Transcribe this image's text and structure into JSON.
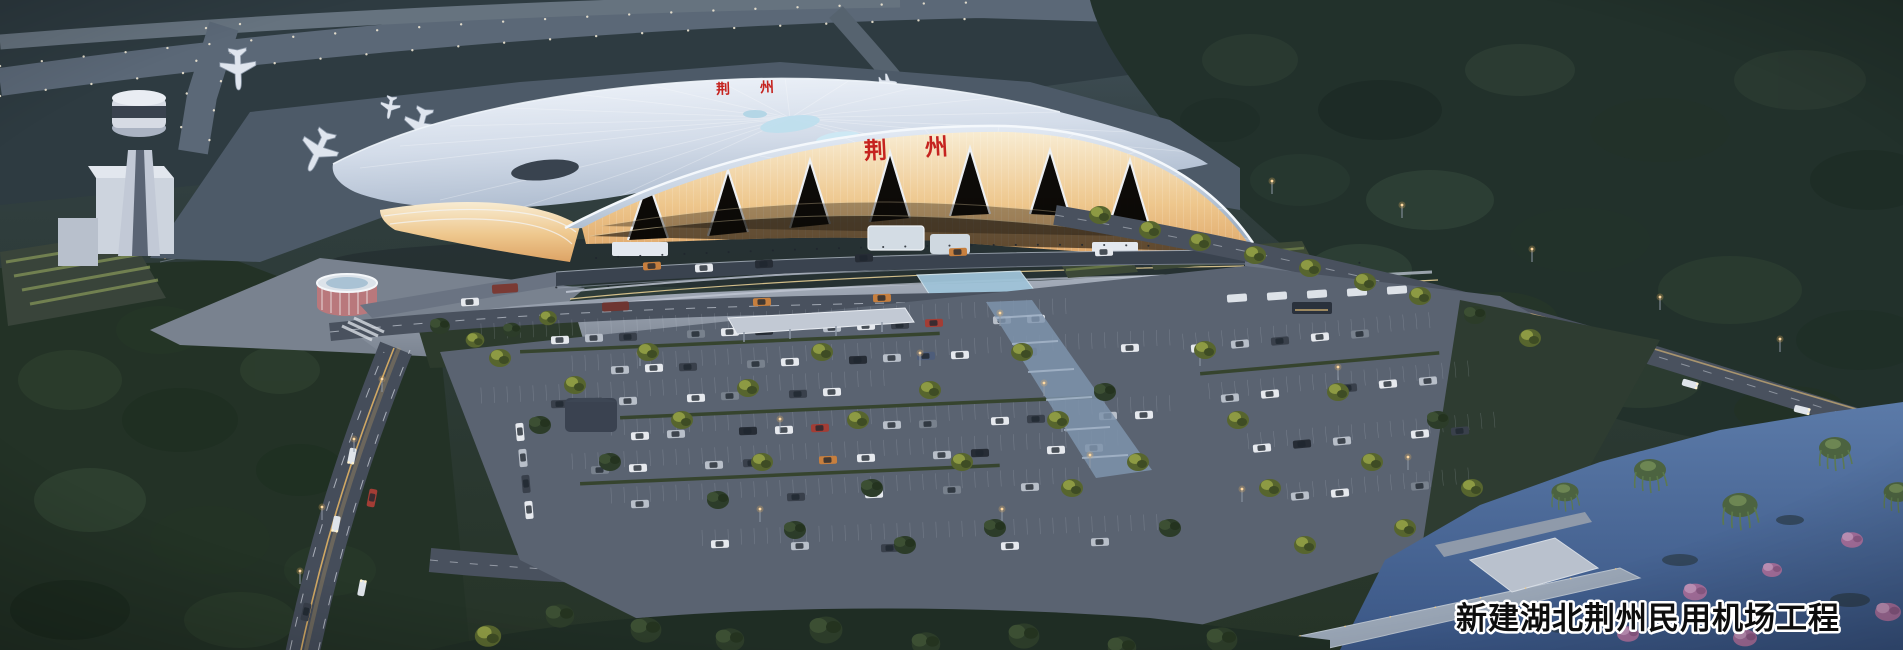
{
  "overlay": {
    "project_caption": "新建湖北荆州民用机场工程"
  },
  "terminal": {
    "facade_sign": "荆州",
    "roof_sign": "荆州"
  },
  "palette": {
    "sign_red": "#c5231f",
    "caption_text": "#0d0d0d",
    "caption_outline": "#ffffff",
    "roof_highlight": "#eef3fa",
    "glass_glow_warm": "#eec488",
    "dusk_ground": "#2b3733",
    "water_blue": "#4c6b9d",
    "taxiway_gray": "#5b6877",
    "tree_lit_green": "#8d9a43",
    "tree_dark_green": "#2c3c29",
    "lamp_amber": "#f5b95f"
  }
}
